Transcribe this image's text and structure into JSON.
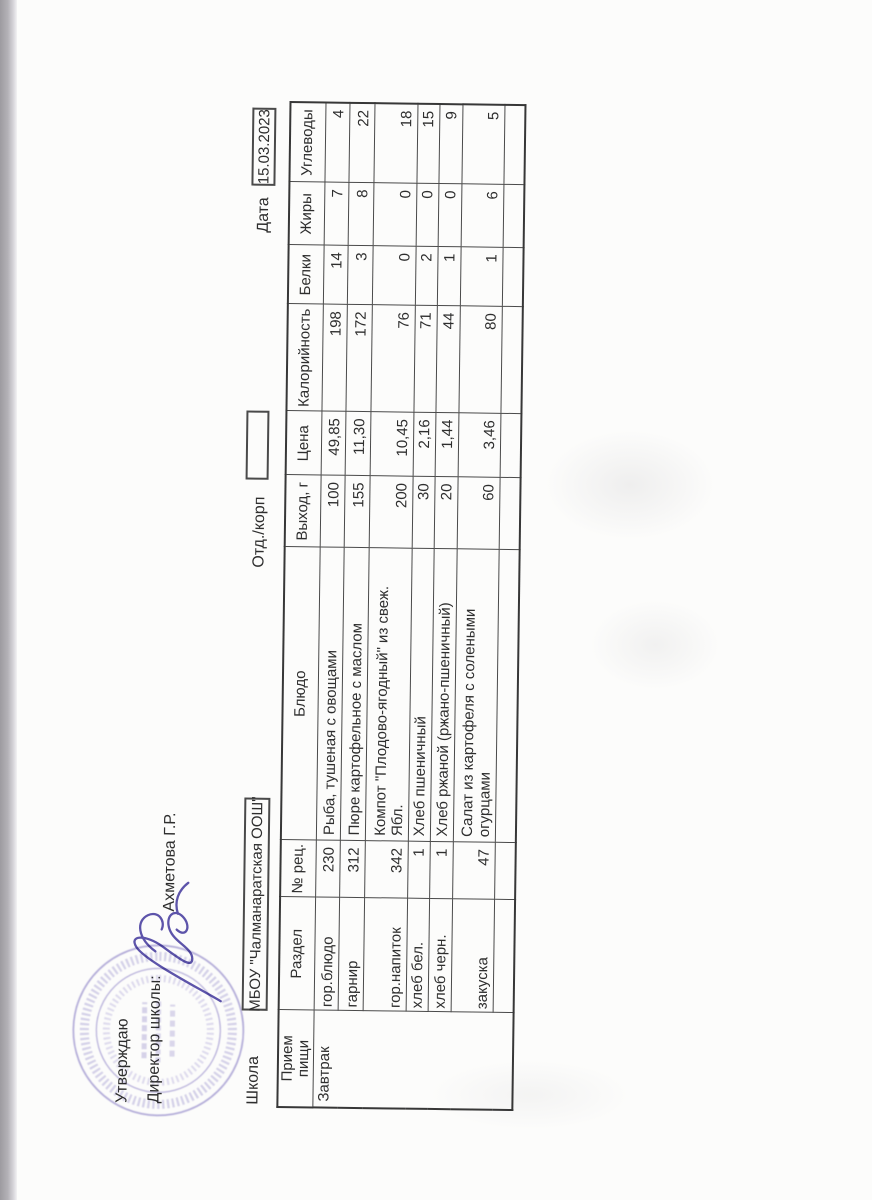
{
  "approval": {
    "approve_label": "Утверждаю",
    "director_label": "Директор школы:",
    "signer": "Ахметова Г.Р."
  },
  "fields": {
    "school": {
      "label": "Школа",
      "value": "МБОУ \"Чалманаратская ООШ\""
    },
    "dept": {
      "label": "Отд./корп",
      "value": ""
    },
    "date": {
      "label": "Дата",
      "value": "15.03.2023"
    }
  },
  "menu_table": {
    "columns": [
      "Прием\nпищи",
      "Раздел",
      "№ рец.",
      "Блюдо",
      "Выход, г",
      "Цена",
      "Калорийность",
      "Белки",
      "Жиры",
      "Углеводы"
    ],
    "meal": "Завтрак",
    "rows": [
      {
        "section": "гор.блюдо",
        "rec": "230",
        "dish": "Рыба, тушеная с овощами",
        "out": "100",
        "price": "49,85",
        "cal": "198",
        "protein": "14",
        "fat": "7",
        "carbs": "4"
      },
      {
        "section": "гарнир",
        "rec": "312",
        "dish": "Пюре картофельное с маслом",
        "out": "155",
        "price": "11,30",
        "cal": "172",
        "protein": "3",
        "fat": "8",
        "carbs": "22"
      },
      {
        "section": "гор.напиток",
        "rec": "342",
        "dish": "Компот \"Плодово-ягодный\" из свеж.\nЯбл.",
        "out": "200",
        "price": "10,45",
        "cal": "76",
        "protein": "0",
        "fat": "0",
        "carbs": "18"
      },
      {
        "section": "хлеб бел.",
        "rec": "1",
        "dish": "Хлеб пшеничный",
        "out": "30",
        "price": "2,16",
        "cal": "71",
        "protein": "2",
        "fat": "0",
        "carbs": "15"
      },
      {
        "section": "хлеб черн.",
        "rec": "1",
        "dish": "Хлеб ржаной (ржано-пшеничный)",
        "out": "20",
        "price": "1,44",
        "cal": "44",
        "protein": "1",
        "fat": "0",
        "carbs": "9"
      },
      {
        "section": "закуска",
        "rec": "47",
        "dish": "Салат из картофеля с солеными\nогурцами",
        "out": "60",
        "price": "3,46",
        "cal": "80",
        "protein": "1",
        "fat": "6",
        "carbs": "5"
      },
      {
        "section": "",
        "rec": "",
        "dish": "",
        "out": "",
        "price": "",
        "cal": "",
        "protein": "",
        "fat": "",
        "carbs": ""
      }
    ]
  },
  "colors": {
    "ink": "#2e2e2e",
    "table_border": "#4a4a4a",
    "stamp": "#8b80c6",
    "signature": "#5d54aa"
  }
}
